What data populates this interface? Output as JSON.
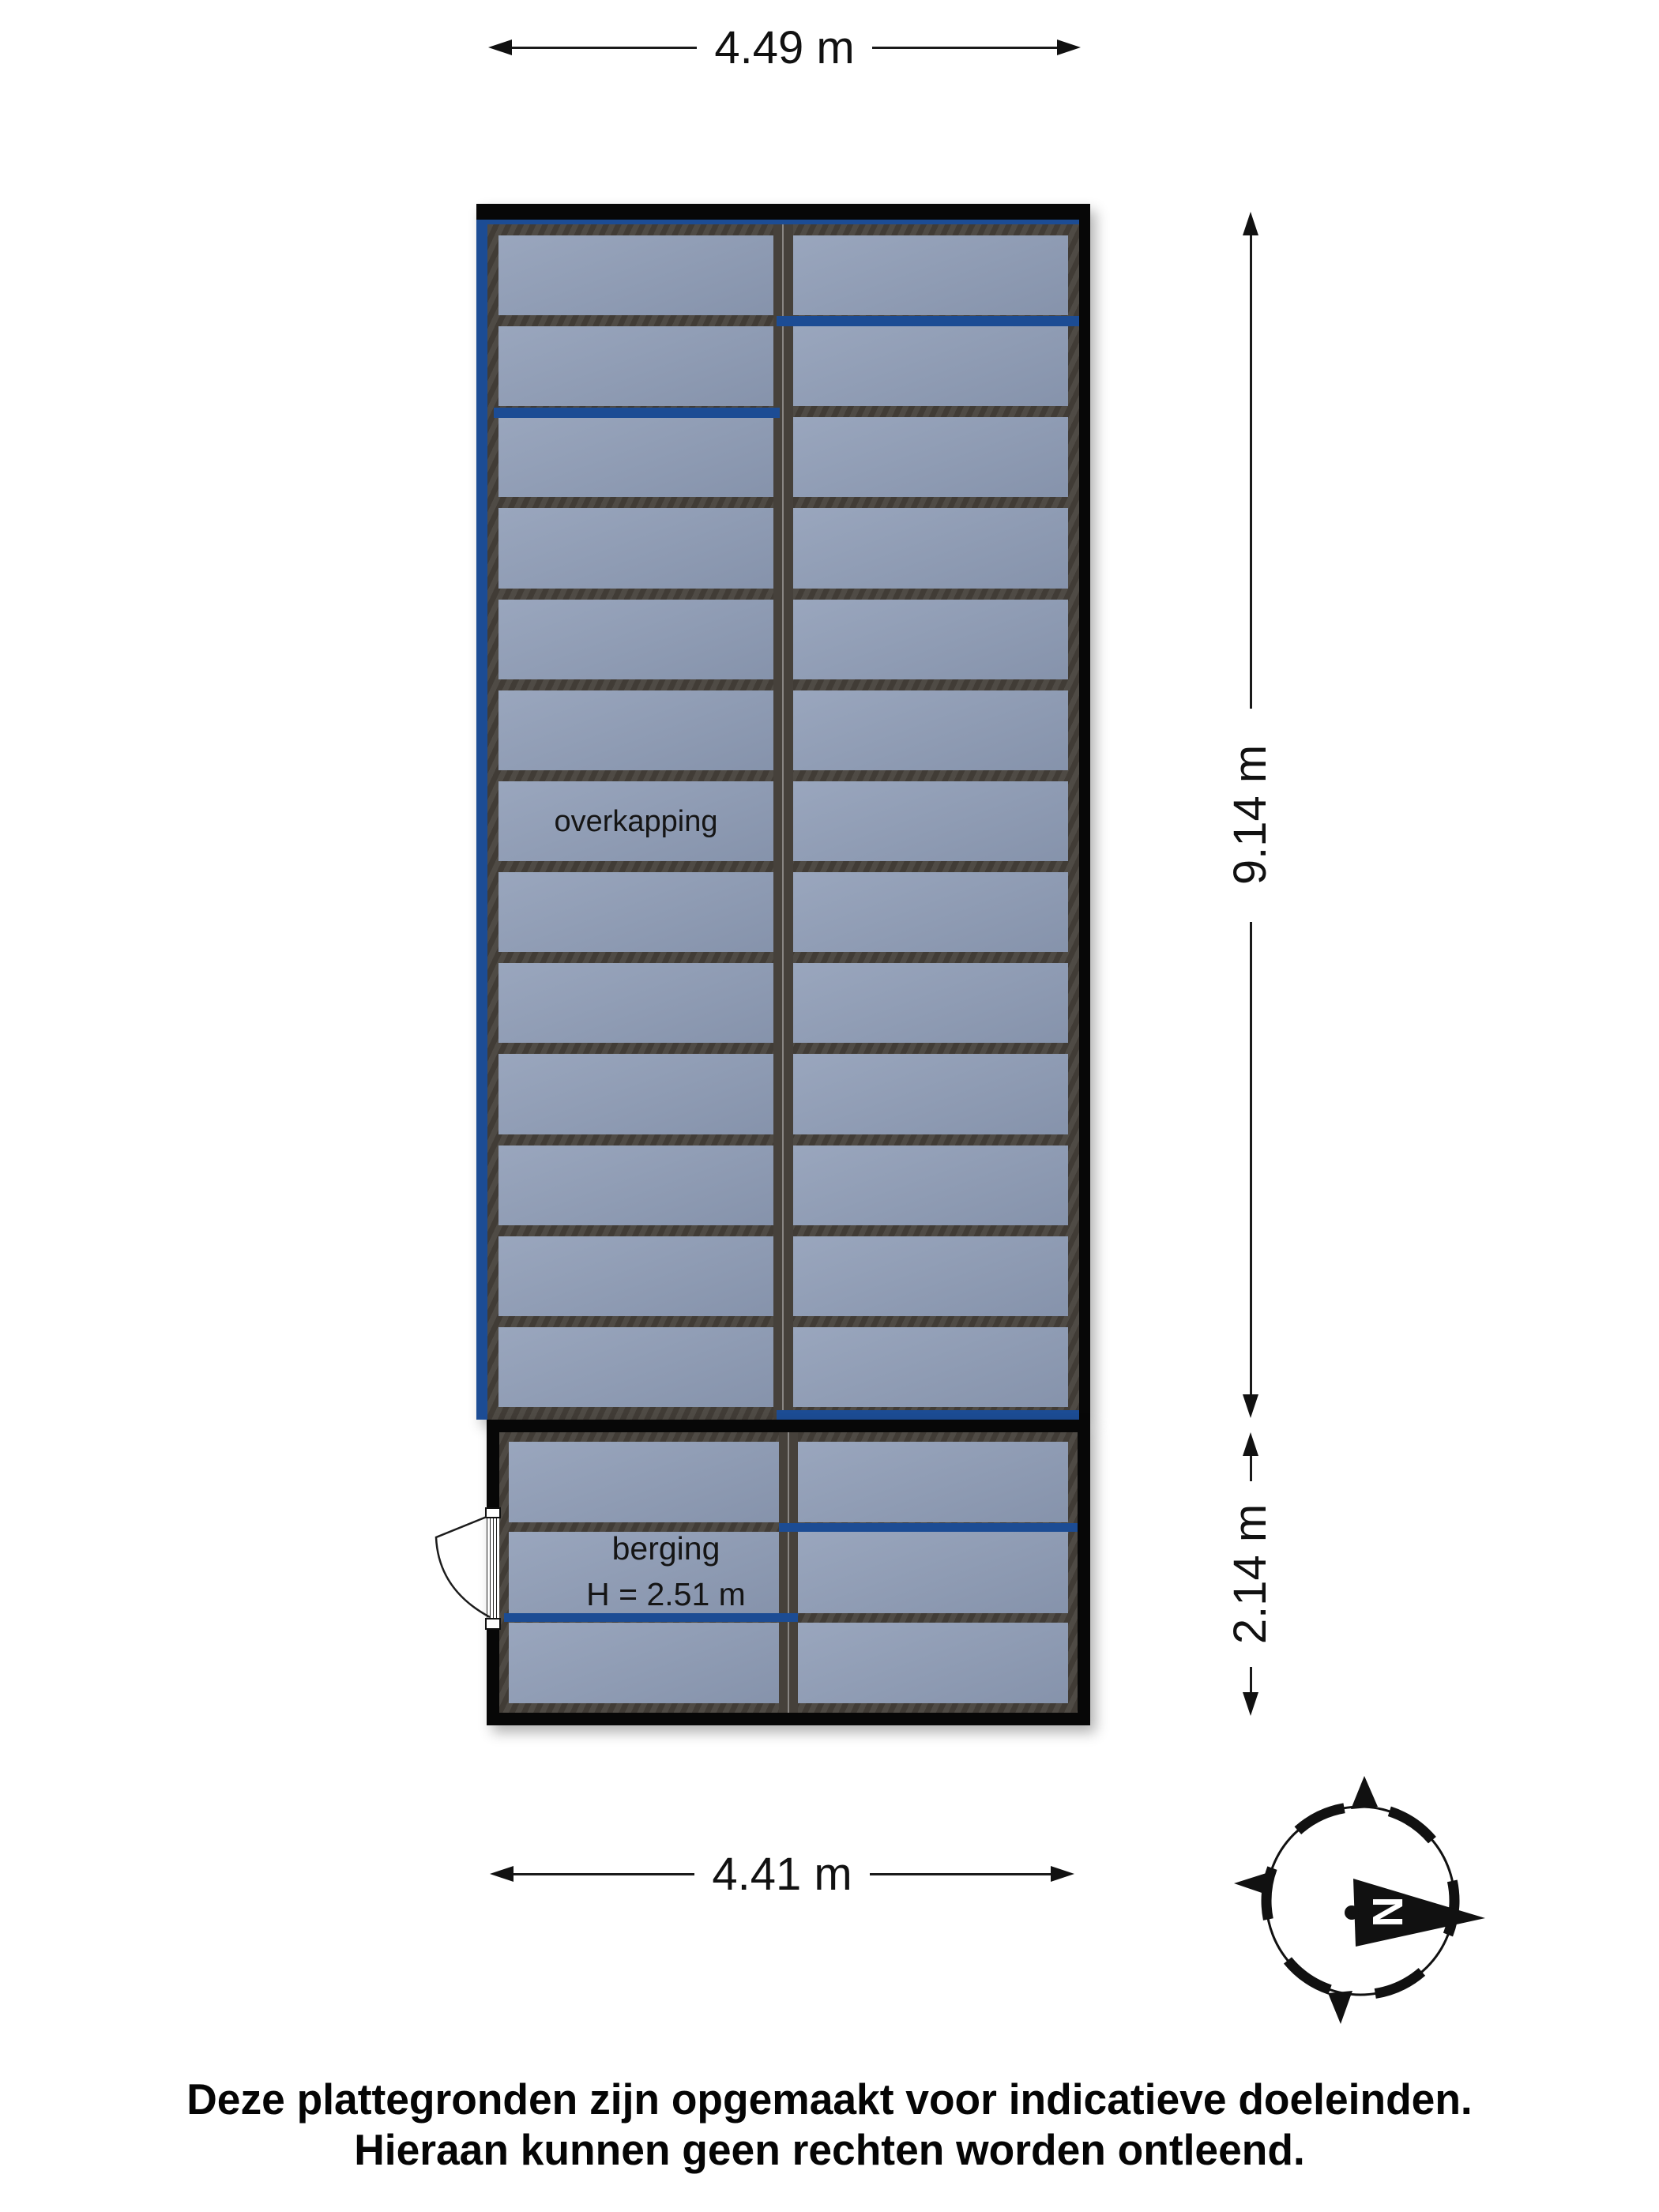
{
  "plan": {
    "overkapping_label": "overkapping",
    "berging_label": "berging",
    "berging_height_label": "H = 2.51 m",
    "grid": {
      "columns": 2,
      "overkapping_rows": 13,
      "berging_rows": 3
    }
  },
  "dimensions": {
    "top": "4.49 m",
    "right_upper": "9.14 m",
    "right_lower": "2.14 m",
    "bottom": "4.41 m"
  },
  "compass": {
    "north_label": "N"
  },
  "disclaimer": {
    "line1": "Deze plattegronden zijn opgemaakt voor indicatieve doeleinden.",
    "line2": "Hieraan kunnen geen rechten worden ontleend."
  },
  "colors": {
    "panel": "#8e9cb6",
    "frame": "#46413b",
    "accent_blue": "#1c4c94",
    "wall_black": "#070707",
    "dimension_line": "#1a1a1a"
  }
}
